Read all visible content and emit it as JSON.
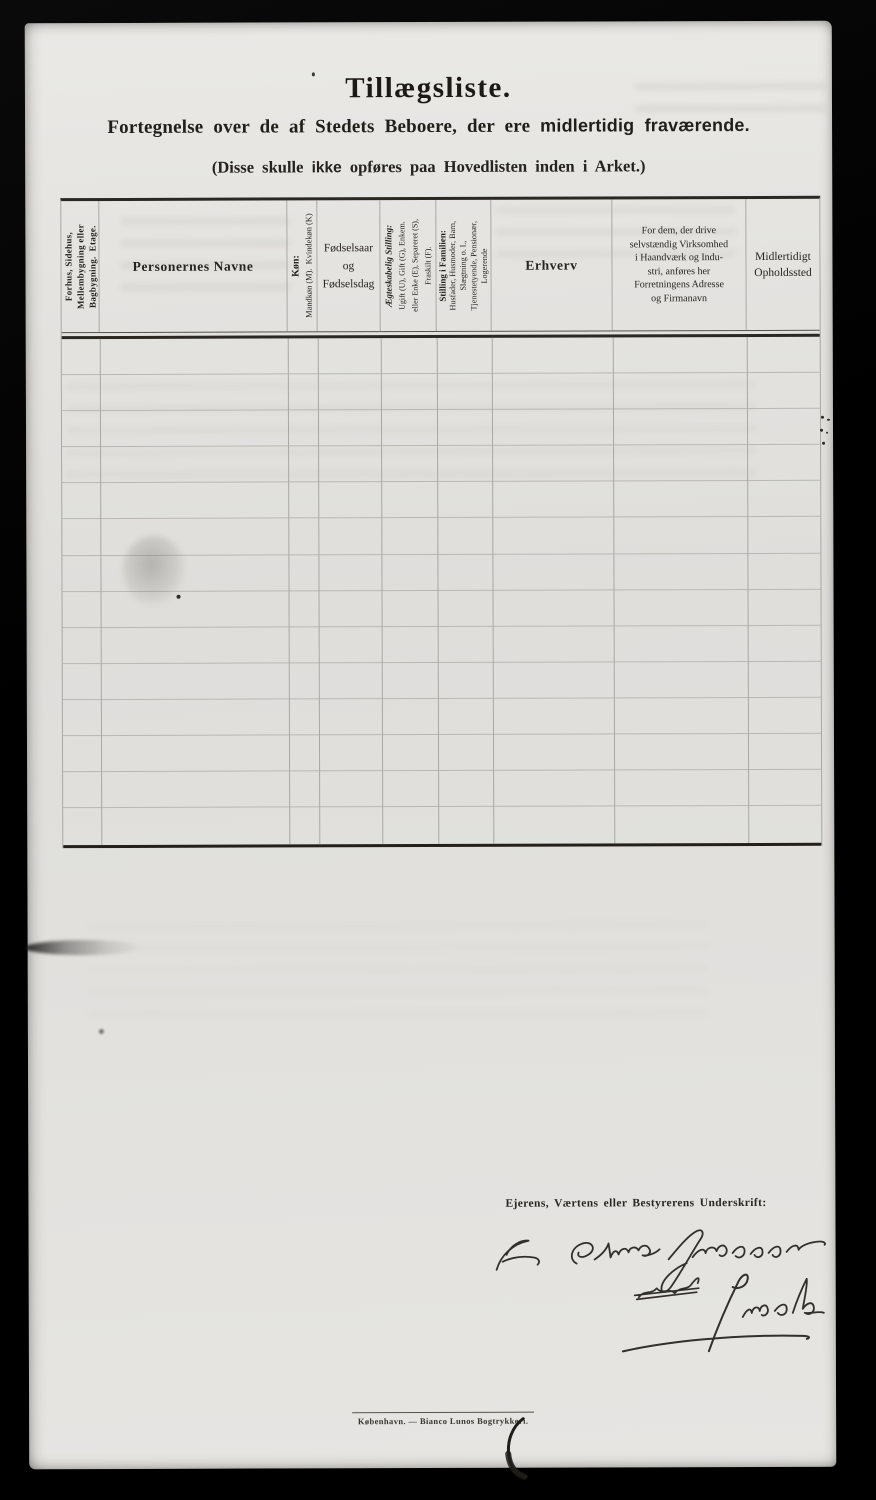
{
  "page": {
    "title": "Tillægsliste.",
    "subtitle_prefix": "Fortegnelse over de af Stedets Beboere, der ere ",
    "subtitle_bold": "midlertidig fraværende.",
    "note_prefix": "(Disse skulle ",
    "note_bold": "ikke",
    "note_suffix": " opføres paa Hovedlisten inden i Arket.)"
  },
  "table": {
    "row_count": 14,
    "columns": [
      {
        "id": "building",
        "width": 38,
        "orientation": "vertical",
        "label": "Forhus, Sidehus,\nMellembygning eller\nBagbygning.  Etage."
      },
      {
        "id": "names",
        "width": 188,
        "orientation": "horizontal",
        "label": "Personernes Navne"
      },
      {
        "id": "sex",
        "width": 30,
        "orientation": "vertical",
        "title": "Køn:",
        "label": "Mandkøn (M).  Kvindekøn (K)"
      },
      {
        "id": "birth",
        "width": 63,
        "orientation": "horizontal",
        "label": "Fødselsaar\nog\nFødselsdag"
      },
      {
        "id": "marital",
        "width": 56,
        "orientation": "vertical",
        "title": "Ægteskabelig Stilling:",
        "label": "Ugift (U), Gift (G), Enkem.\neller Enke (E), Separeret (S),\nFraskilt (F)."
      },
      {
        "id": "family",
        "width": 55,
        "orientation": "vertical",
        "title": "Stilling i Familien:",
        "label": "Husfader, Husmoder, Barn,\nSlægtning o. l.,\nTjenestetyende, Pensionær,\nLogerende"
      },
      {
        "id": "occupation",
        "width": 121,
        "orientation": "horizontal",
        "label": "Erhverv"
      },
      {
        "id": "business",
        "width": 134,
        "orientation": "horizontal",
        "label": "For dem, der drive\nselvstændig Virksomhed\ni Haandværk og Indu-\nstri, anføres her\nForretningens Adresse\nog Firmanavn"
      },
      {
        "id": "whereabouts",
        "width": 73,
        "orientation": "horizontal",
        "label": "Midlertidigt\nOpholdssted"
      }
    ]
  },
  "signature": {
    "label": "Ejerens, Værtens eller Bestyrerens Underskrift:",
    "line1": "For Elias Johansen",
    "struck": "ved",
    "line2": "J. Mohr"
  },
  "footer": {
    "printer": "København. — Bianco Lunos Bogtrykkeri."
  },
  "colors": {
    "paper": "#e2e1de",
    "ink": "#26231f",
    "grid_light": "#b9b8b4",
    "rule_dark": "#2b2824",
    "background": "#000000"
  }
}
